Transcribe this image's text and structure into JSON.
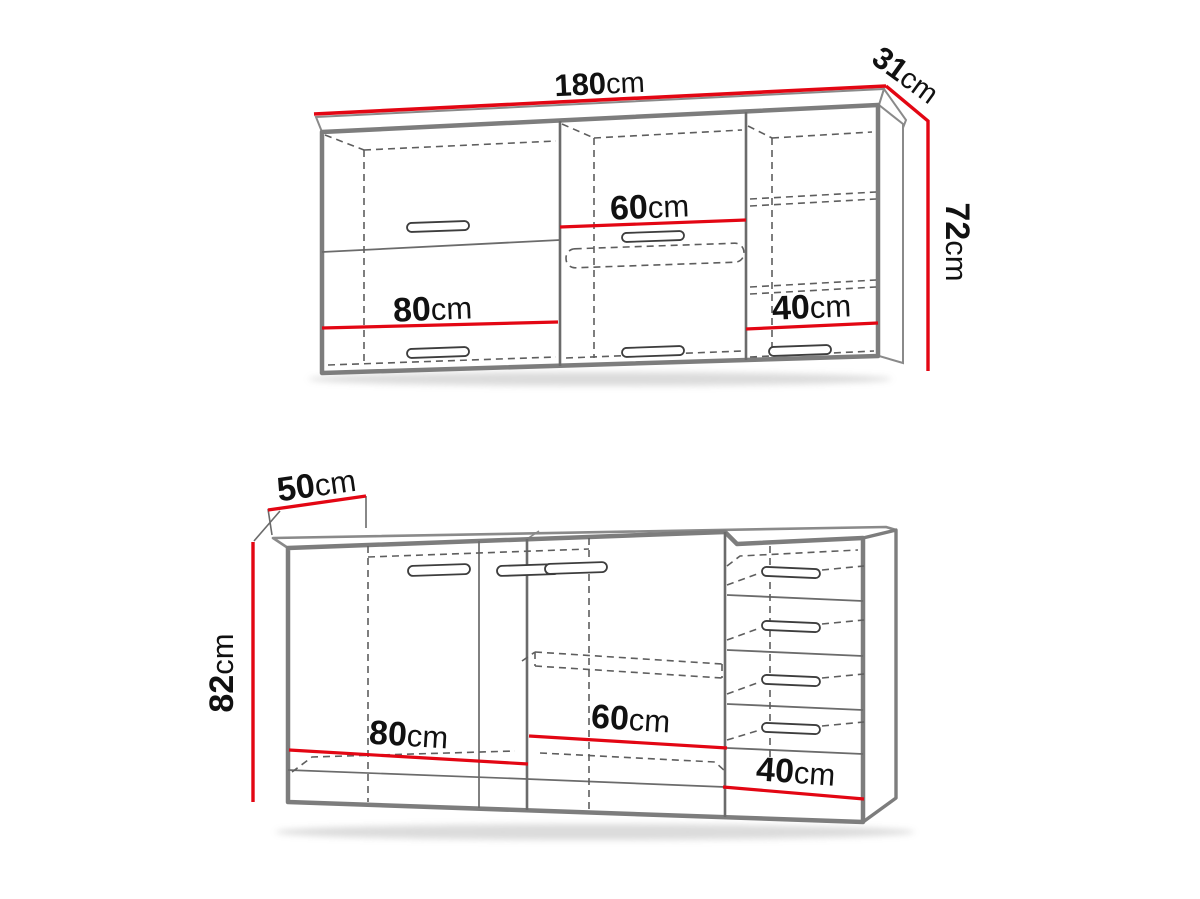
{
  "diagram": {
    "type": "kitchen-cabinet-dimension-diagram",
    "unit": "cm",
    "background": "#ffffff"
  },
  "colors": {
    "dimension_red": "#e30613",
    "outline_gray": "#7d7d7d",
    "line_mid_gray": "#6b6b6b",
    "line_thin_gray": "#565656",
    "dashed_gray": "#5e5e5e",
    "label_black": "#111111",
    "shadow_gray": "#9a9a9a"
  },
  "wall_cabinet": {
    "name": "upper wall cabinet",
    "width_label": {
      "value": "180",
      "unit": "cm"
    },
    "depth_label": {
      "value": "31",
      "unit": "cm"
    },
    "height_label": {
      "value": "72",
      "unit": "cm"
    },
    "sections": [
      {
        "width_label": {
          "value": "80",
          "unit": "cm"
        }
      },
      {
        "width_label": {
          "value": "60",
          "unit": "cm"
        }
      },
      {
        "width_label": {
          "value": "40",
          "unit": "cm"
        }
      }
    ]
  },
  "base_cabinet": {
    "name": "lower base cabinet",
    "depth_label": {
      "value": "50",
      "unit": "cm"
    },
    "height_label": {
      "value": "82",
      "unit": "cm"
    },
    "sections": [
      {
        "width_label": {
          "value": "80",
          "unit": "cm"
        }
      },
      {
        "width_label": {
          "value": "60",
          "unit": "cm"
        }
      },
      {
        "width_label": {
          "value": "40",
          "unit": "cm"
        }
      }
    ]
  }
}
